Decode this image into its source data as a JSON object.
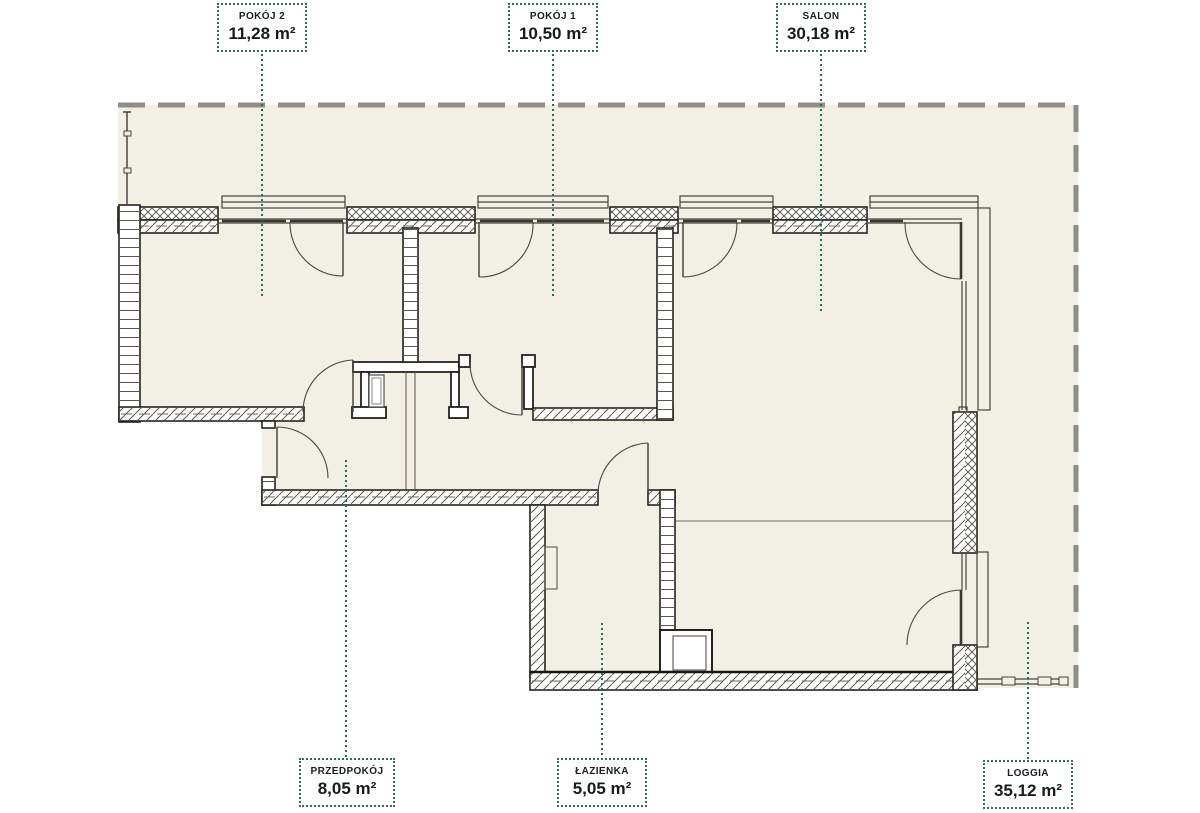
{
  "plan": {
    "rooms": [
      {
        "name": "POKÓJ 2",
        "area": "11,28 m²"
      },
      {
        "name": "POKÓJ 1",
        "area": "10,50 m²"
      },
      {
        "name": "SALON",
        "area": "30,18 m²"
      },
      {
        "name": "PRZEDPOKÓJ",
        "area": "8,05 m²"
      },
      {
        "name": "ŁAZIENKA",
        "area": "5,05 m²"
      },
      {
        "name": "LOGGIA",
        "area": "35,12 m²"
      }
    ],
    "colors": {
      "accent_teal": "#2b6b5e",
      "floor_cream": "#f2efe4",
      "boundary_gray": "#8f8e88",
      "wall_line": "#23221e"
    }
  }
}
